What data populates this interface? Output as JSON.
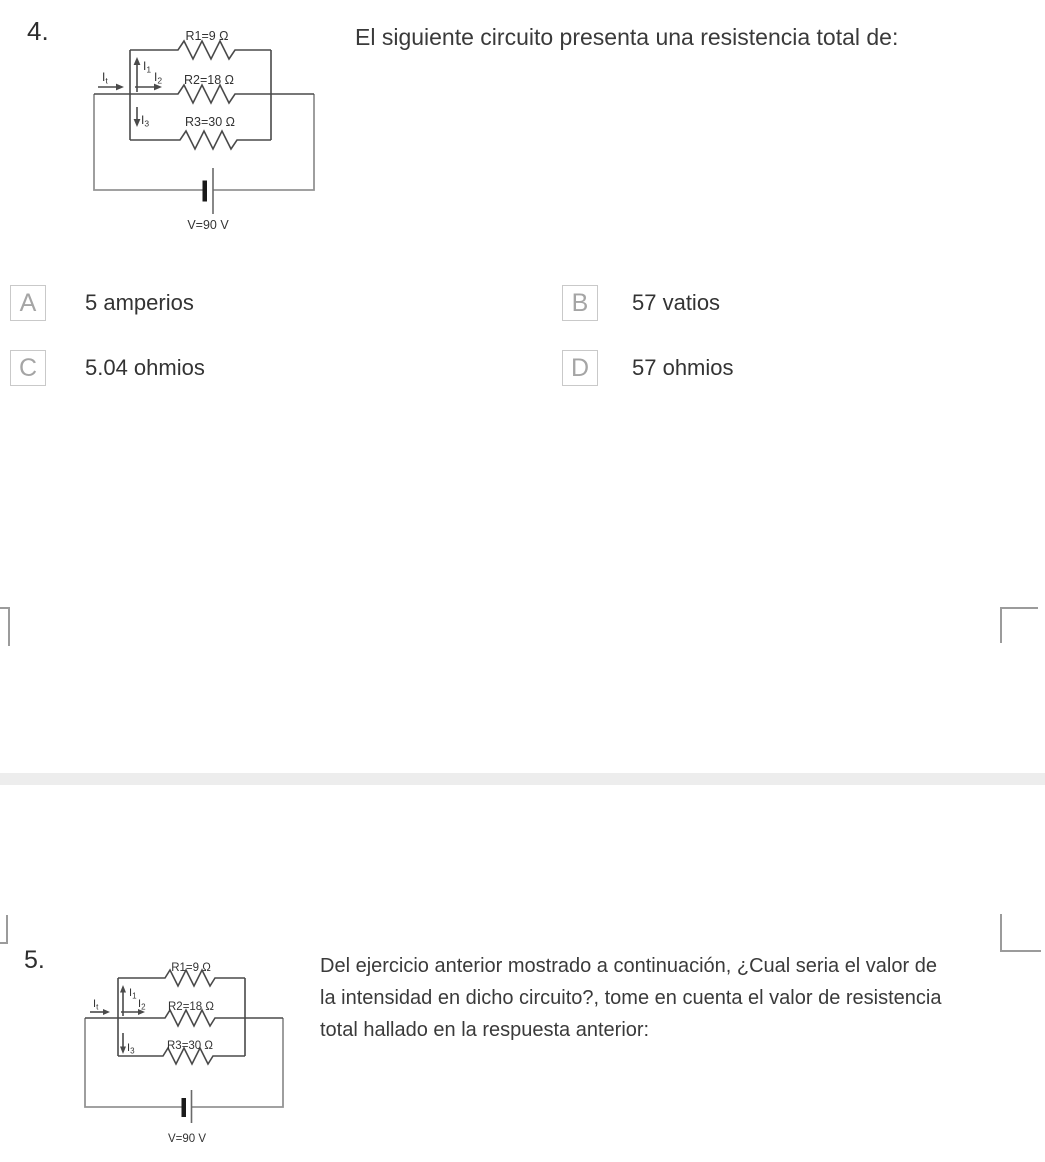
{
  "questions": [
    {
      "number": "4.",
      "text": "El siguiente circuito presenta una resistencia total de:",
      "options": [
        {
          "letter": "A",
          "text": "5 amperios"
        },
        {
          "letter": "B",
          "text": "57 vatios"
        },
        {
          "letter": "C",
          "text": "5.04 ohmios"
        },
        {
          "letter": "D",
          "text": "57 ohmios"
        }
      ]
    },
    {
      "number": "5.",
      "text_lines": [
        "Del ejercicio anterior mostrado a continuación, ¿Cual seria el valor de",
        "la intensidad en dicho circuito?, tome en cuenta el valor de resistencia",
        "total hallado en la respuesta anterior:"
      ]
    }
  ],
  "circuit": {
    "r1_label": "R1=9 Ω",
    "r2_label": "R2=18 Ω",
    "r3_label": "R3=30 Ω",
    "v_label": "V=90 V",
    "i_base": "I",
    "i_t_sub": "t",
    "i1_sub": "1",
    "i2_sub": "2",
    "i3_sub": "3"
  },
  "colors": {
    "divider": "#ededed",
    "option_letter": "#a5a5a5",
    "option_border": "#c9c9c9",
    "body_text": "#3a3a3a",
    "wire_dark": "#4a4a4a",
    "wire_light": "#949494"
  }
}
